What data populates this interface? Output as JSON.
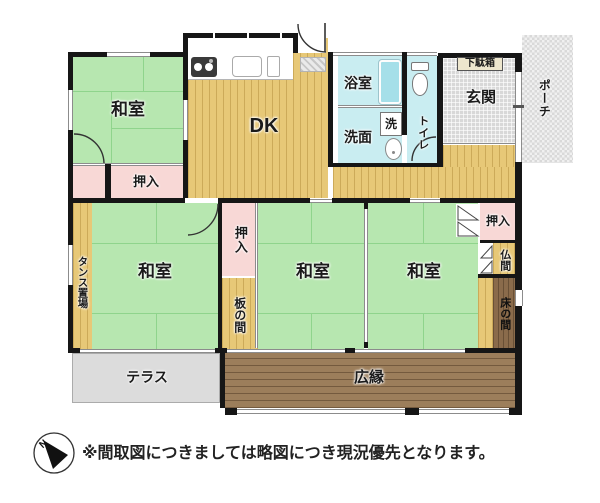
{
  "rooms": {
    "washitsu_nw": {
      "label": "和室"
    },
    "washitsu_w": {
      "label": "和室"
    },
    "washitsu_c": {
      "label": "和室"
    },
    "washitsu_e": {
      "label": "和室"
    },
    "dk": {
      "label": "DK"
    },
    "bathroom": {
      "label": "浴室"
    },
    "washroom": {
      "label": "洗面"
    },
    "laundry": {
      "label": "洗"
    },
    "toilet": {
      "label": "トイレ"
    },
    "entrance": {
      "label": "玄関"
    },
    "shoe_cabinet": {
      "label": "下駄箱"
    },
    "porch": {
      "label": "ポーチ"
    },
    "closet_nw": {
      "label": "押入"
    },
    "closet_center": {
      "label": "押入"
    },
    "closet_ne": {
      "label": "押入"
    },
    "tansu_space": {
      "label": "タンス置場"
    },
    "itanoma": {
      "label": "板の間"
    },
    "butsuma": {
      "label": "仏間"
    },
    "tokonoma": {
      "label": "床の間"
    },
    "terrace": {
      "label": "テラス"
    },
    "hiroen": {
      "label": "広縁"
    }
  },
  "footer": {
    "disclaimer": "※間取図につきましては略図につき現況優先となります。",
    "compass_north_label": "N"
  },
  "colors": {
    "tatami_green": "#b7e7b0",
    "closet_pink": "#f8d8d6",
    "wood_tan": "#e7c877",
    "water_cyan": "#c9edf1",
    "veranda_brown": "#9c7e5b",
    "tokonoma_brown": "#8a6b4b",
    "terrace_gray": "#dcdcdc",
    "entrance_gray": "#d8d8d8",
    "wall_black": "#161616"
  }
}
